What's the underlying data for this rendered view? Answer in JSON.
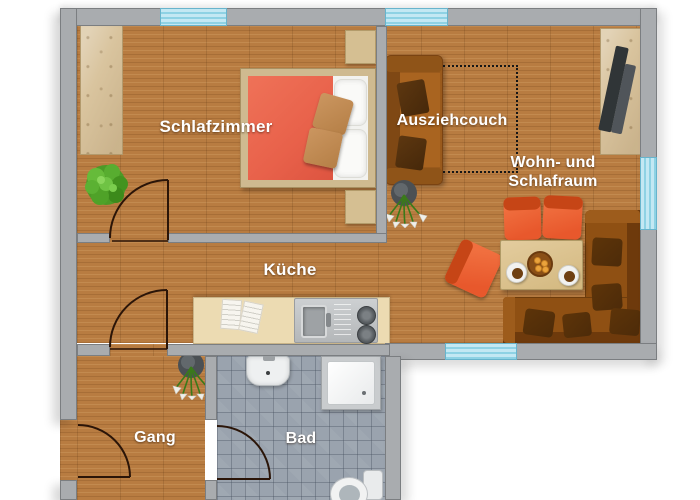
{
  "labels": {
    "schlafzimmer": "Schlafzimmer",
    "ausziehcouch": "Ausziehcouch",
    "wohnraum_line1": "Wohn- und",
    "wohnraum_line2": "Schlafraum",
    "kueche": "Küche",
    "gang": "Gang",
    "bad": "Bad"
  },
  "colors": {
    "wall": "#a9acaf",
    "wall-border": "#7b7e81",
    "window": "#c3e8f3",
    "window-stripe": "#8ed2e4",
    "wood": "#b87c41",
    "tile": "#9aa3ae",
    "blanket": "#e8614a",
    "couch": "#9a5a1c",
    "bench": "#8f5013",
    "chair": "#e8582c",
    "table": "#e3cc9e",
    "counter": "#ecdbb2",
    "label": "#ffffff"
  },
  "furniture_icons": [
    "wardrobe-icon",
    "double-bed-icon",
    "nightstand-icon",
    "plant-bush-icon",
    "sofa-icon",
    "pullout-extension-outline",
    "tv-sideboard-icon",
    "flower-vase-icon",
    "dining-table-icon",
    "chair-icon",
    "corner-bench-icon",
    "plate-of-cookies-icon",
    "coffee-cup-icon",
    "kitchen-counter-icon",
    "open-book-icon",
    "sink-icon",
    "stove-burner-icon",
    "bathroom-sink-icon",
    "shower-icon",
    "toilet-icon",
    "door-swing-icon",
    "window-icon"
  ]
}
